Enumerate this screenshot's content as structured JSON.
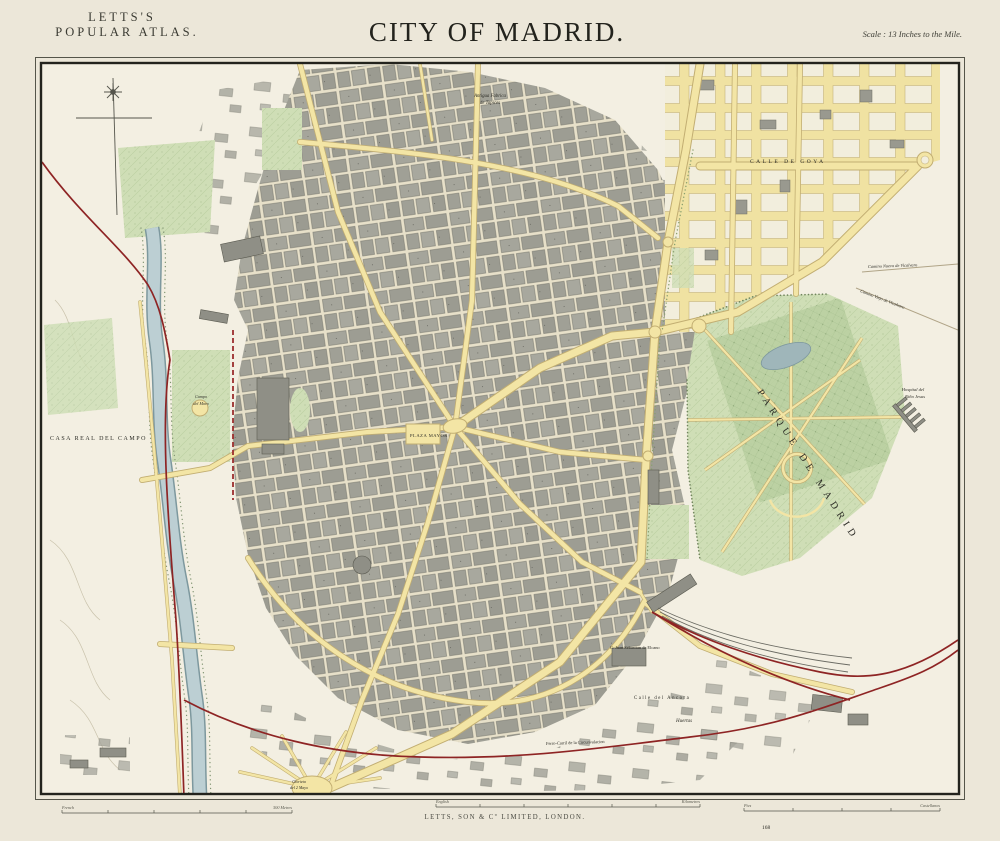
{
  "header": {
    "atlas_line1": "LETTS'S",
    "atlas_line2": "POPULAR ATLAS.",
    "title": "CITY OF MADRID.",
    "scale_note": "Scale : 13 Inches to the Mile."
  },
  "footer": {
    "publisher": "LETTS, SON & Cº LIMITED, LONDON.",
    "plate_number": "168",
    "scalebar_metres": {
      "left": "French",
      "right": "500 Metres"
    },
    "scalebar_english": {
      "left": "English",
      "right": "Kilometres"
    },
    "scalebar_spanish": {
      "left": "Pies",
      "right": "Castellanos"
    }
  },
  "colors": {
    "paper": "#ece7d9",
    "map_base": "#f3efe2",
    "street_yellow": "#f3e5a5",
    "street_casing": "#c2ae72",
    "block_gray": "#a3a399",
    "park_green": "#cfdeb6",
    "river_blue": "#bccfd3",
    "railway_red": "#8e2424",
    "ink": "#2c2c26"
  },
  "map": {
    "labels": [
      {
        "id": "casa-real-del-campo",
        "text": "CASA REAL DEL CAMPO",
        "x": 50,
        "y": 440,
        "size": 6,
        "spacing": 1.5,
        "color": "#5f5f55"
      },
      {
        "id": "parque-de-madrid",
        "text": "PARQUE DE MADRID",
        "x": 757,
        "y": 392,
        "size": 10,
        "spacing": 5,
        "rotate": 57,
        "color": "#6b6b60"
      },
      {
        "id": "plaza-mayor",
        "text": "PLAZA MAYOR",
        "x": 410,
        "y": 437,
        "size": 4.6,
        "spacing": 0.5,
        "color": "#4e4e46"
      },
      {
        "id": "calle-de-goya",
        "text": "CALLE DE GOYA",
        "x": 750,
        "y": 163,
        "size": 5.5,
        "spacing": 2.5,
        "color": "#8b8b80"
      },
      {
        "id": "fabrica-tapices-1",
        "text": "Antigua Fabrica",
        "x": 490,
        "y": 97,
        "size": 4.8,
        "italic": true,
        "anchor": "middle",
        "color": "#5f5f55"
      },
      {
        "id": "fabrica-tapices-2",
        "text": "de Tapices",
        "x": 490,
        "y": 104,
        "size": 4.8,
        "italic": true,
        "anchor": "middle",
        "color": "#5f5f55"
      },
      {
        "id": "hospital-nino-1",
        "text": "Hospital del",
        "x": 913,
        "y": 391,
        "size": 4.6,
        "italic": true,
        "anchor": "middle",
        "color": "#55554c"
      },
      {
        "id": "hospital-nino-2",
        "text": "Niño Jesus",
        "x": 915,
        "y": 398,
        "size": 4.6,
        "italic": true,
        "anchor": "middle",
        "color": "#55554c"
      },
      {
        "id": "camino-nuevo",
        "text": "Camino Nuevo de Vicalvaro",
        "x": 868,
        "y": 268,
        "size": 4.4,
        "italic": true,
        "rotate": -2,
        "color": "#6b6b60"
      },
      {
        "id": "camino-viejo",
        "text": "Camino Viejo de Vicalvaro",
        "x": 860,
        "y": 292,
        "size": 4.4,
        "italic": true,
        "rotate": 21,
        "color": "#6b6b60"
      },
      {
        "id": "calle-del-ancora",
        "text": "Calle del Ancora",
        "x": 634,
        "y": 699,
        "size": 4.8,
        "spacing": 1.5,
        "color": "#55554c"
      },
      {
        "id": "calle-elcano",
        "text": "C. Juan Sebastian de Elcano",
        "x": 610,
        "y": 649,
        "size": 4.4,
        "color": "#55554c"
      },
      {
        "id": "huertas",
        "text": "Huertas",
        "x": 676,
        "y": 722,
        "size": 5,
        "italic": true,
        "color": "#55554c"
      },
      {
        "id": "ferrocarril",
        "text": "Ferro-Carril de la Circunvalacion",
        "x": 546,
        "y": 745,
        "size": 4.4,
        "rotate": -2,
        "color": "#7c4038"
      },
      {
        "id": "glorieta-1",
        "text": "Glorieta",
        "x": 299,
        "y": 783,
        "size": 4,
        "italic": true,
        "anchor": "middle",
        "color": "#55554c"
      },
      {
        "id": "glorieta-2",
        "text": "del 2 Mayo",
        "x": 299,
        "y": 789,
        "size": 4,
        "italic": true,
        "anchor": "middle",
        "color": "#55554c"
      },
      {
        "id": "campo-del-moro-1",
        "text": "Campo",
        "x": 201,
        "y": 398,
        "size": 4.2,
        "italic": true,
        "anchor": "middle",
        "color": "#5e6e52"
      },
      {
        "id": "campo-del-moro-2",
        "text": "del Moro",
        "x": 201,
        "y": 405,
        "size": 4.2,
        "italic": true,
        "anchor": "middle",
        "color": "#5e6e52"
      }
    ]
  }
}
